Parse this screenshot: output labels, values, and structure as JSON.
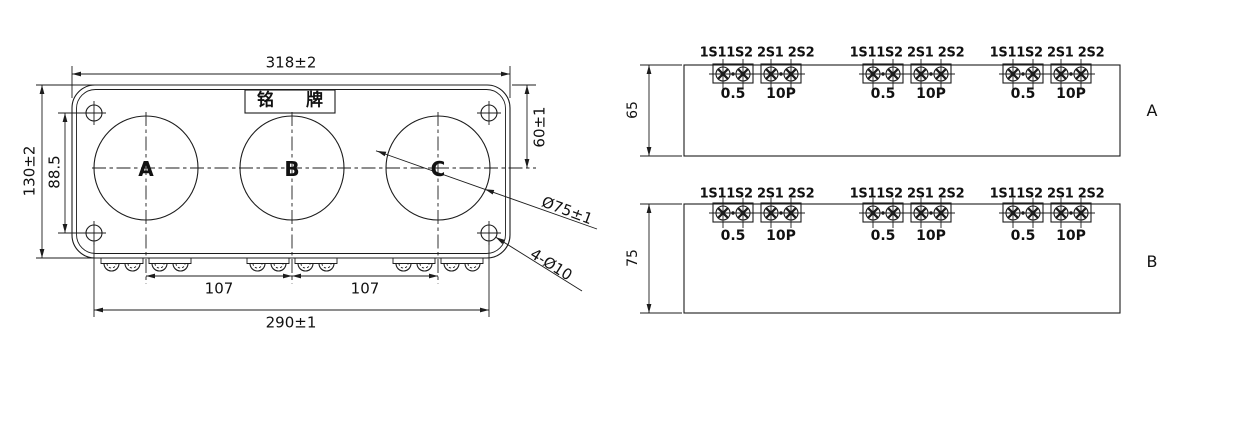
{
  "colors": {
    "line": "#1c1c1c",
    "text": "#111111",
    "bg": "#ffffff"
  },
  "front_view": {
    "nameplate_label": "铭 牌",
    "circle_labels": [
      "A",
      "B",
      "C"
    ],
    "dims": {
      "overall_width": "318±2",
      "overall_height": "130±2",
      "mount_hole_vertical_pitch": "88.5",
      "top_edge_to_center": "60±1",
      "window_diameter": "Ø75±1",
      "mount_holes": "4-Ø10",
      "pitch_ab": "107",
      "pitch_bc": "107",
      "mount_hole_horizontal_pitch": "290±1"
    }
  },
  "terminal_views": [
    {
      "view_label": "A",
      "height_dim": "65",
      "groups": [
        {
          "terminal_marks": "1S11S2 2S1 2S2",
          "class_left": "0.5",
          "class_right": "10P"
        },
        {
          "terminal_marks": "1S11S2 2S1 2S2",
          "class_left": "0.5",
          "class_right": "10P"
        },
        {
          "terminal_marks": "1S11S2 2S1 2S2",
          "class_left": "0.5",
          "class_right": "10P"
        }
      ]
    },
    {
      "view_label": "B",
      "height_dim": "75",
      "groups": [
        {
          "terminal_marks": "1S11S2 2S1 2S2",
          "class_left": "0.5",
          "class_right": "10P"
        },
        {
          "terminal_marks": "1S11S2 2S1 2S2",
          "class_left": "0.5",
          "class_right": "10P"
        },
        {
          "terminal_marks": "1S11S2 2S1 2S2",
          "class_left": "0.5",
          "class_right": "10P"
        }
      ]
    }
  ]
}
